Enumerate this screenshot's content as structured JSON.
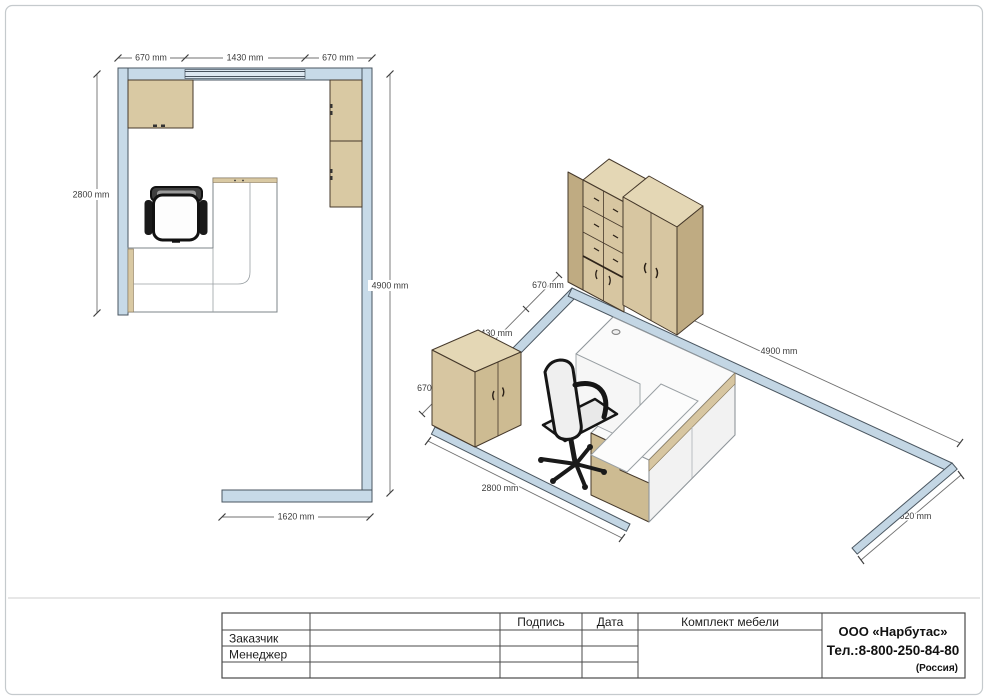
{
  "plan": {
    "dim_top": [
      "670 mm",
      "1430 mm",
      "670 mm"
    ],
    "dim_left": "2800 mm",
    "dim_right": "4900 mm",
    "dim_bottom": "1620 mm"
  },
  "iso": {
    "dim_back_wall": [
      "670 mm",
      "1430 mm",
      "670 mm"
    ],
    "dim_right_wall": "4900 mm",
    "dim_left_wall": "2800 mm",
    "dim_front_wall": "1620 mm"
  },
  "titleblock": {
    "col_signature": "Подпись",
    "col_date": "Дата",
    "product_title": "Комплект мебели",
    "row_customer": "Заказчик",
    "row_manager": "Менеджер",
    "company_name": "ООО «Нарбутас»",
    "company_phone": "Тел.:8-800-250-84-80",
    "company_country": "(Россия)"
  },
  "colors": {
    "wall_fill": "#c7dae8",
    "wall_fill_iso": "#c3d6e4",
    "window_fill": "#dde8f1",
    "wood_front": "#d7c6a1",
    "wood_top": "#e4d7b5",
    "wood_side": "#bfab82",
    "wood_light": "#cdbb92",
    "wood_strip": "#d9c9a3",
    "desk_top": "#fafafa",
    "panel_white": "#f2f2f2",
    "chair_seat": "#e9e9e9"
  }
}
